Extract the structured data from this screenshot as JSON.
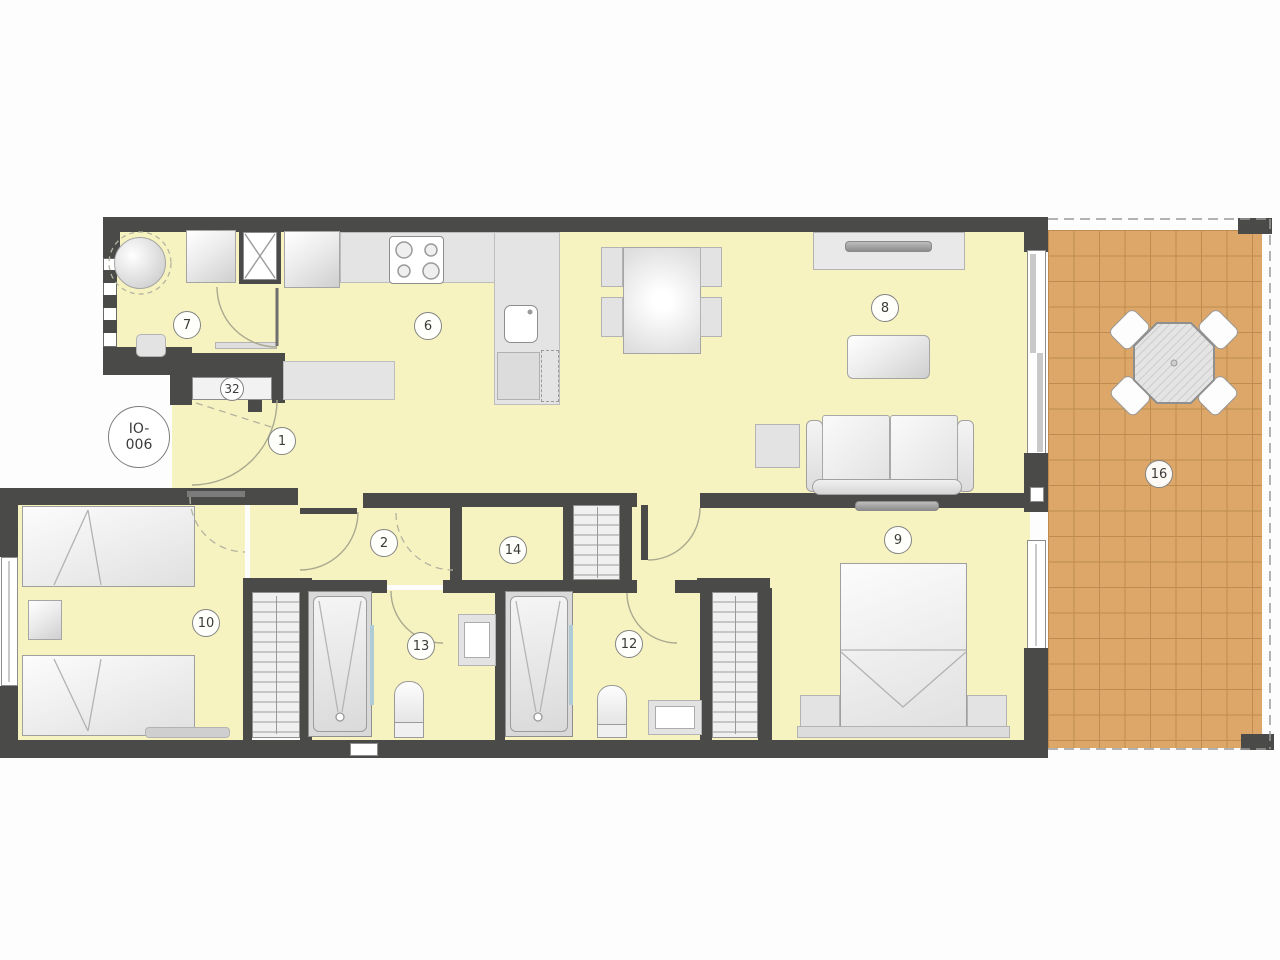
{
  "unit_badge": {
    "line1": "IO-",
    "line2": "006"
  },
  "rooms": [
    {
      "number": "7"
    },
    {
      "number": "32"
    },
    {
      "number": "1"
    },
    {
      "number": "6"
    },
    {
      "number": "8"
    },
    {
      "number": "2"
    },
    {
      "number": "14"
    },
    {
      "number": "13"
    },
    {
      "number": "12"
    },
    {
      "number": "10"
    },
    {
      "number": "9"
    },
    {
      "number": "16"
    }
  ],
  "colors": {
    "floor": "#f7f3c0",
    "wall": "#4a4a48",
    "terrace": "#dca768",
    "furniture": "#e3e3e3"
  }
}
